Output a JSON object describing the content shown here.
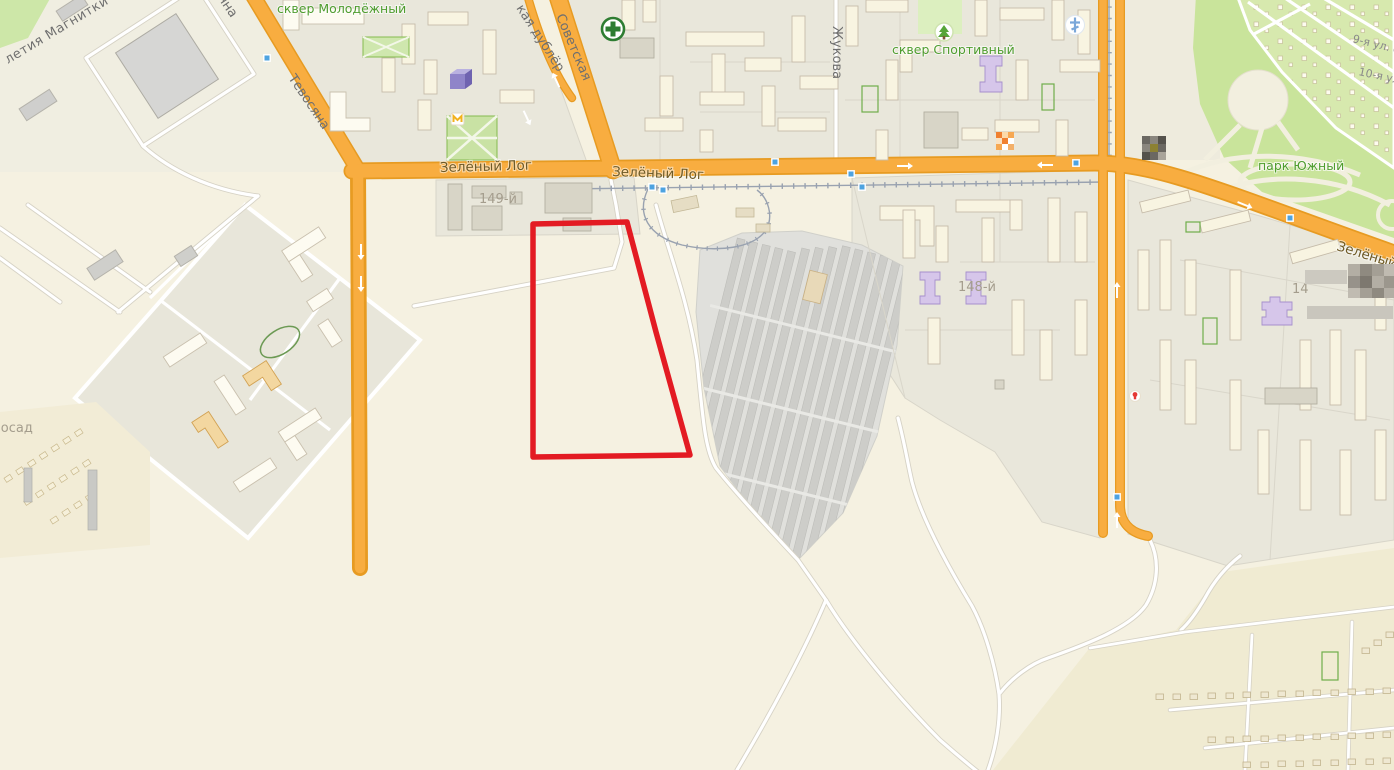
{
  "map": {
    "streets": {
      "magnitki": "летия Магнитки",
      "tevosyana": "Тевосяна",
      "sovetskaya": "Советская",
      "sovetskaya_dubler": "кая дублёр",
      "zelyony_log": "Зелёный Лог",
      "zhukova": "Жукова",
      "garden_street_9": "9-я ул. са",
      "garden_street_10": "10-я ул."
    },
    "places": {
      "skver_molodyozhny": "сквер Молодёжный",
      "skver_sportivny": "сквер Спортивный",
      "park_yuzhny": "парк Южный",
      "district_149": "149-й",
      "district_148": "148-й",
      "district_partial": "14",
      "posad": "Посад"
    },
    "annotation": {
      "color": "#e31b23"
    },
    "colors": {
      "main_road_fill": "#f8ad40",
      "main_road_casing": "#e79b22",
      "field_background": "#f5f1e1",
      "city_block": "#e9e7db",
      "building": "#f8f4e1",
      "park_green": "#c9e49b",
      "dacha_green": "#d7e9ae",
      "green_label": "#4f9d2f",
      "street_label": "#6f6f6f",
      "road_label": "#6e5a26",
      "district_label": "#a49d8d",
      "transit_stop": "#4ea3e0",
      "tram_rail": "#99a2b0"
    },
    "icons": {
      "pharmacy": "green-cross",
      "church": "blue-cross",
      "park_tree": "tree",
      "building_3d": "purple-building",
      "censored_poi_1": "pixelated-icon",
      "censored_poi_2": "pixelated-icon",
      "censored_poi_3": "pixelated-region",
      "shop_poi": "red-dot",
      "small_shop": "yellow-sign"
    }
  }
}
